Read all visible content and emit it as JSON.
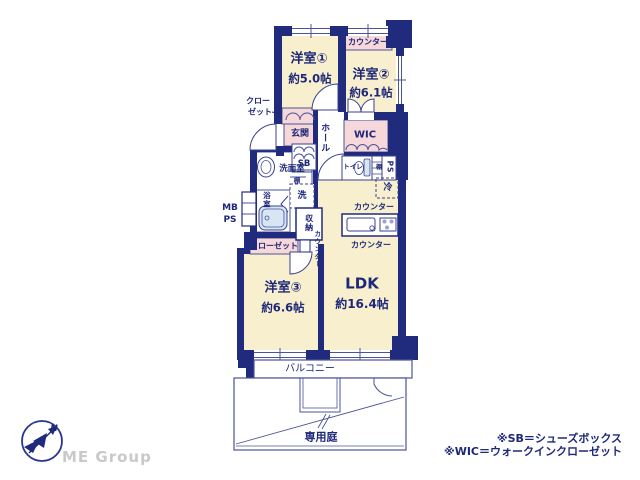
{
  "plan": {
    "labels": {
      "counter_bedroom2": "カウンター",
      "bedroom1_name": "洋室①",
      "bedroom1_size": "約5.0帖",
      "bedroom2_name": "洋室②",
      "bedroom2_size": "約6.1帖",
      "closet1_line1": "クロー",
      "closet1_line2": "ゼット",
      "entrance": "玄関",
      "hall": "ホール",
      "shoe_box": "SB",
      "wic": "WIC",
      "washroom": "洗面室",
      "shelf_washroom": "棚",
      "washer": "洗",
      "bathroom": "浴室",
      "storage": "収納",
      "counter_ldk_side": "カウンター",
      "toilet": "トイレ",
      "shelf_toilet": "棚",
      "pipe_space": "PS",
      "fridge": "冷",
      "counter_kitchen_back": "カウンター",
      "counter_kitchen_front": "カウンター",
      "meter_box_line1": "MB",
      "meter_box_line2": "PS",
      "closet3": "クローゼット",
      "bedroom3_name": "洋室③",
      "bedroom3_size": "約6.6帖",
      "ldk_name": "LDK",
      "ldk_size": "約16.4帖",
      "balcony": "バルコニー",
      "private_garden": "専用庭"
    },
    "colors": {
      "wall_navy": "#212b7d",
      "room_cream": "#f8efcf",
      "closet_pink": "#f6d7da",
      "fixture_blue": "#d7e6f2",
      "thin_line": "#4a5499",
      "label_navy": "#1e2878"
    }
  },
  "footer": {
    "compass_north": "N",
    "brand": "ME Group",
    "notes": [
      "※SB＝シューズボックス",
      "※WIC＝ウォークインクローゼット"
    ]
  }
}
